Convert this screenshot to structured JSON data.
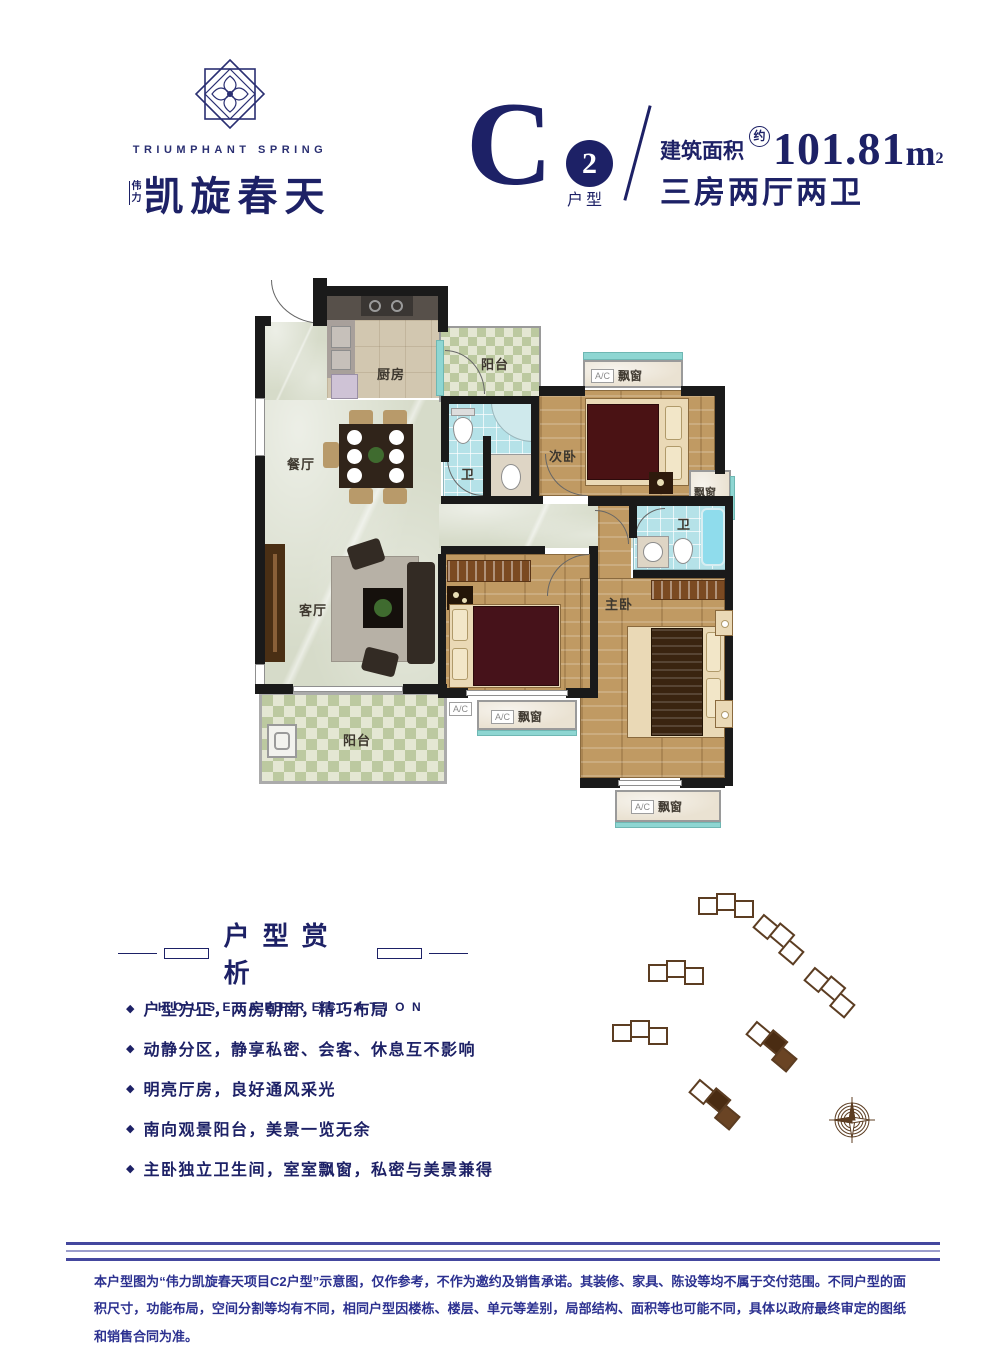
{
  "brand": {
    "logo_en": "TRIUMPHANT SPRING",
    "logo_prefix": "伟力",
    "logo_cn": "凯旋春天"
  },
  "header": {
    "unit_letter": "C",
    "unit_number": "2",
    "unit_label": "户型",
    "area_label": "建筑面积",
    "area_approx": "约",
    "area_value": "101.81",
    "area_unit": "m",
    "area_exp": "2",
    "layout_desc": "三房两厅两卫"
  },
  "floorplan": {
    "rooms": {
      "kitchen": "厨房",
      "balcony": "阳台",
      "bath": "卫",
      "second_bedroom": "次卧",
      "dining": "餐厅",
      "living": "客厅",
      "master_bedroom": "主卧"
    },
    "labels": {
      "bay_window": "飘窗",
      "ac": "A/C"
    }
  },
  "appreciation": {
    "title": "户型赏析",
    "subtitle": "HOUSE APPRECIATION",
    "bullet_icon": "◆",
    "bullets": [
      "户型方正，两房朝南，精巧布局",
      "动静分区，静享私密、会客、休息互不影响",
      "明亮厅房，良好通风采光",
      "南向观景阳台，美景一览无余",
      "主卧独立卫生间，室室飘窗，私密与美景兼得"
    ]
  },
  "disclaimer": "本户型图为“伟力凯旋春天项目C2户型”示意图，仅作参考，不作为邀约及销售承诺。其装修、家具、陈设等均不属于交付范围。不同户型的面积尺寸，功能布局，空间分割等均有不同，相同户型因楼栋、楼层、单元等差别，局部结构、面积等也可能不同，具体以政府最终审定的图纸和销售合同为准。",
  "colors": {
    "brand_navy": "#1d2166",
    "disclaimer_blue": "#2c3190",
    "site_brown": "#5c3d22",
    "wall_black": "#1a1a1a"
  }
}
